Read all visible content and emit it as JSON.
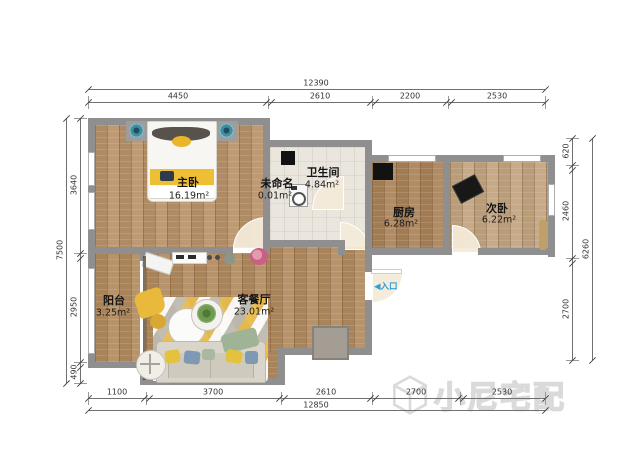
{
  "plan": {
    "entrance_arrow": "◀",
    "entrance_label": "入口",
    "watermark": "小尼宅配",
    "rooms": [
      {
        "name": "主卧",
        "area": "16.19m²"
      },
      {
        "name": "未命名",
        "area": "0.01m²"
      },
      {
        "name": "卫生间",
        "area": "4.84m²"
      },
      {
        "name": "厨房",
        "area": "6.28m²"
      },
      {
        "name": "次卧",
        "area": "6.22m²"
      },
      {
        "name": "阳台",
        "area": "3.25m²"
      },
      {
        "name": "客餐厅",
        "area": "23.01m²"
      }
    ]
  },
  "dimensions": {
    "top": {
      "total": "12390",
      "segments": [
        "4450",
        "2610",
        "2200",
        "2530"
      ]
    },
    "bottom": {
      "total": "12850",
      "segments": [
        "1100",
        "3700",
        "2610",
        "2700",
        "2530"
      ]
    },
    "left": {
      "total": "7500",
      "segments": [
        "3640",
        "2950",
        "490"
      ]
    },
    "right": {
      "total": "6260",
      "segments": [
        "620",
        "2460",
        "2700"
      ]
    }
  },
  "colors": {
    "wall": "#8f8f8f",
    "entrance_blue": "#2f9fd8",
    "watermark_gray": "#dadada",
    "accent_yellow": "#e8b93a",
    "floor_wood": "#b28b60"
  }
}
